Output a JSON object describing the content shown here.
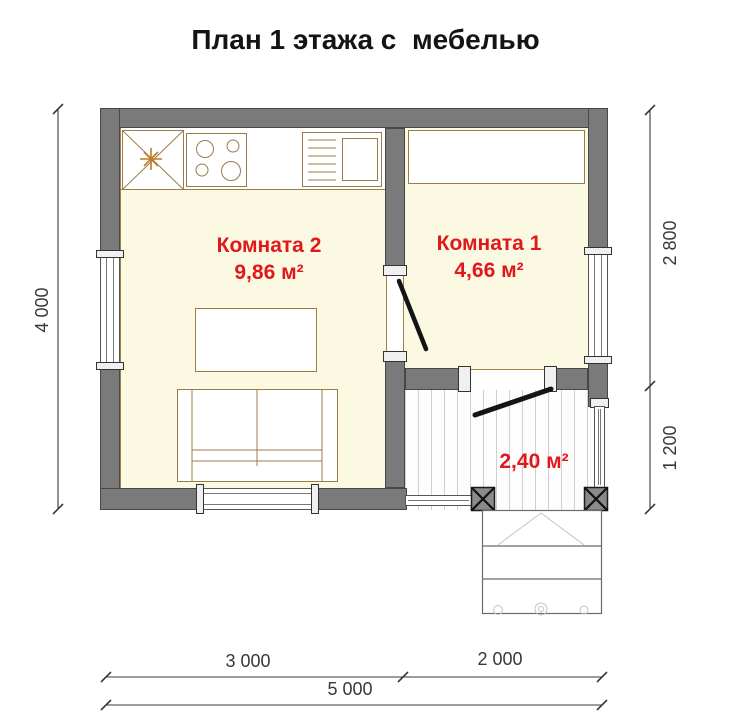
{
  "title": "План 1 этажа с  мебелью",
  "rooms": {
    "room2": {
      "name": "Комната 2",
      "area": "9,86 м²"
    },
    "room1": {
      "name": "Комната 1",
      "area": "4,66 м²"
    },
    "porch": {
      "area": "2,40 м²"
    }
  },
  "dimensions": {
    "left_total": "4 000",
    "right_upper": "2 800",
    "right_lower": "1 200",
    "bottom_left": "3 000",
    "bottom_right": "2 000",
    "bottom_total": "5 000"
  },
  "colors": {
    "wall": "#7a7a7a",
    "floor": "#fcf9e2",
    "furniture_outline": "#9b7b4b",
    "label_red": "#e0181c",
    "door": "#141414",
    "dimension": "#3a3a3a",
    "deck_line": "#d0d0d0",
    "star_orange": "#c07a28"
  }
}
